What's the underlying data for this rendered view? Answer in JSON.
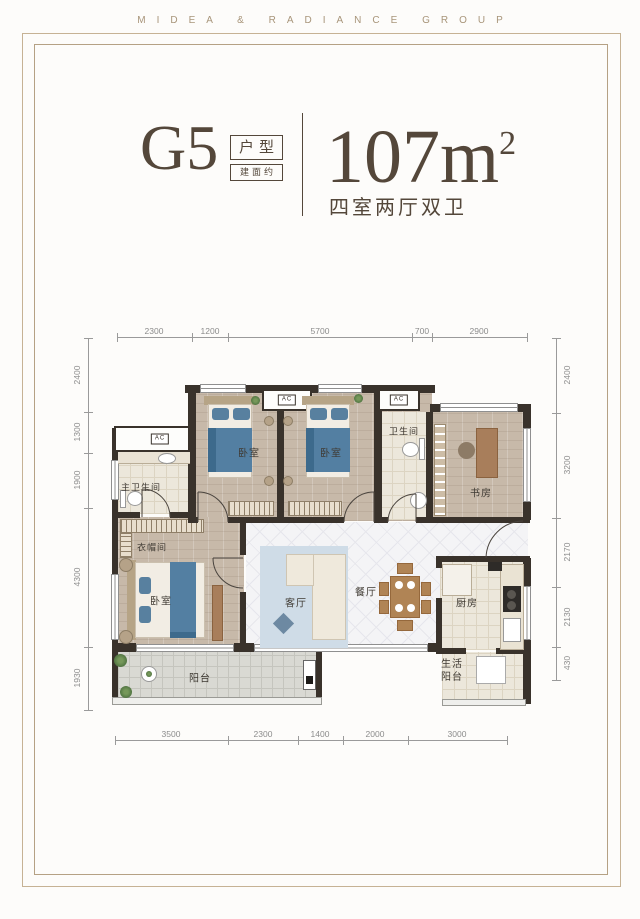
{
  "header": {
    "brand": "MIDEA & RADIANCE GROUP"
  },
  "title": {
    "unit_code": "G5",
    "tag_type": "户型",
    "tag_area_prefix": "建面约",
    "area_value": "107m",
    "area_superscript": "2",
    "subtitle": "四室两厅双卫"
  },
  "plan": {
    "ac_label": "AC",
    "rooms": {
      "master_bathroom": "主卫生间",
      "bedroom_top_left": "卧室",
      "bedroom_top_right": "卧室",
      "bathroom": "卫生间",
      "study": "书房",
      "cloakroom": "衣帽间",
      "master_bedroom": "卧室",
      "living_room": "客厅",
      "dining_room": "餐厅",
      "kitchen": "厨房",
      "balcony": "阳台",
      "service_balcony": "生活阳台"
    },
    "dimensions": {
      "top": [
        "2300",
        "1200",
        "5700",
        "700",
        "2900"
      ],
      "bottom": [
        "3500",
        "2300",
        "1400",
        "2000",
        "3000"
      ],
      "left": [
        "2400",
        "1300",
        "1900",
        "4300",
        "1930"
      ],
      "right": [
        "2400",
        "3200",
        "2170",
        "2130",
        "430"
      ]
    }
  },
  "colors": {
    "frame_gold": "#bca986",
    "title_brown": "#54473a",
    "wall_dark": "#39322b",
    "dimension_gray": "#8c8c8c",
    "bed_blue": "#537fa2",
    "rug_blue": "#cfdce7"
  }
}
